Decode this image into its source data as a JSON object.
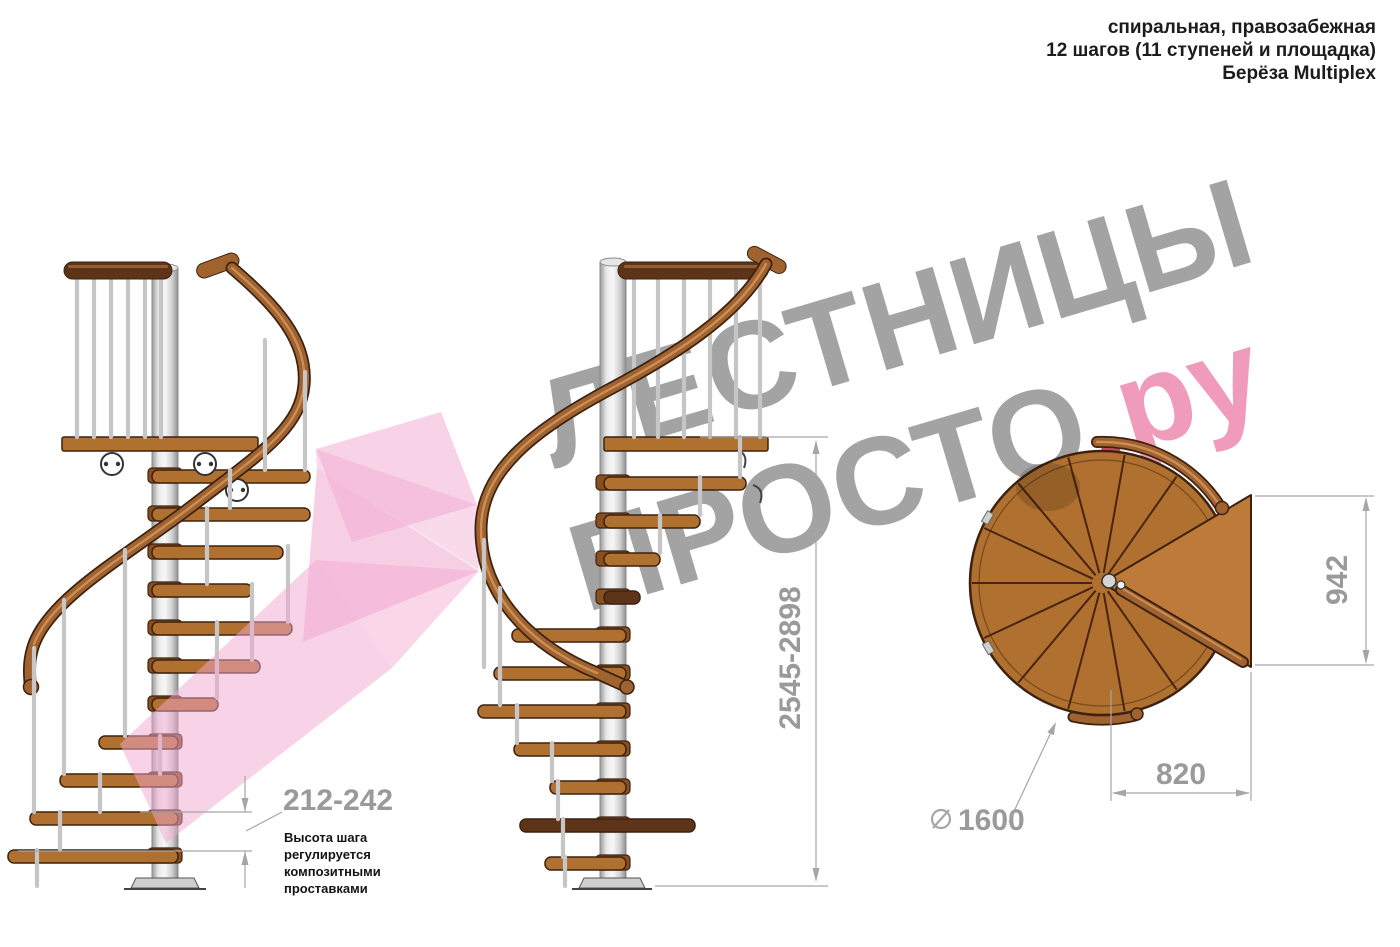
{
  "header": {
    "lines": [
      "спиральная, правозабежная",
      "12 шагов (11 ступеней и площадка)",
      "Берёза Multiplex"
    ]
  },
  "watermark": {
    "word1": "ЛЕСТНИЦЫ",
    "word2": "ПРОСТО",
    "dot": ".",
    "domain": "ру"
  },
  "dimensions": {
    "step_height": "212-242",
    "step_height_note": [
      "Высота шага",
      "регулируется",
      "композитными",
      "проставками"
    ],
    "total_height": "2545-2898",
    "plan_height": "942",
    "plan_width": "820",
    "diameter_symbol": "⌀",
    "diameter": "1600"
  },
  "colors": {
    "wood": "#b0702f",
    "wood-light": "#bd7a38",
    "wood-dark": "#8a4f1f",
    "outline": "#3d2210",
    "rail": "#a0622f",
    "rail-highlight": "#d2965c",
    "rail-dark": "#5e3418",
    "baluster": "#c6c6c6",
    "dim": "#a6a6a6",
    "dim-text": "#9a9a9a",
    "ink": "#1c1c1c",
    "note": "#141414",
    "wm-gray": "#9c9c9c",
    "wm-pink": "#f093b5",
    "wm-dot": "#cb3a50",
    "arrow-pink": "#f1a7cf"
  }
}
